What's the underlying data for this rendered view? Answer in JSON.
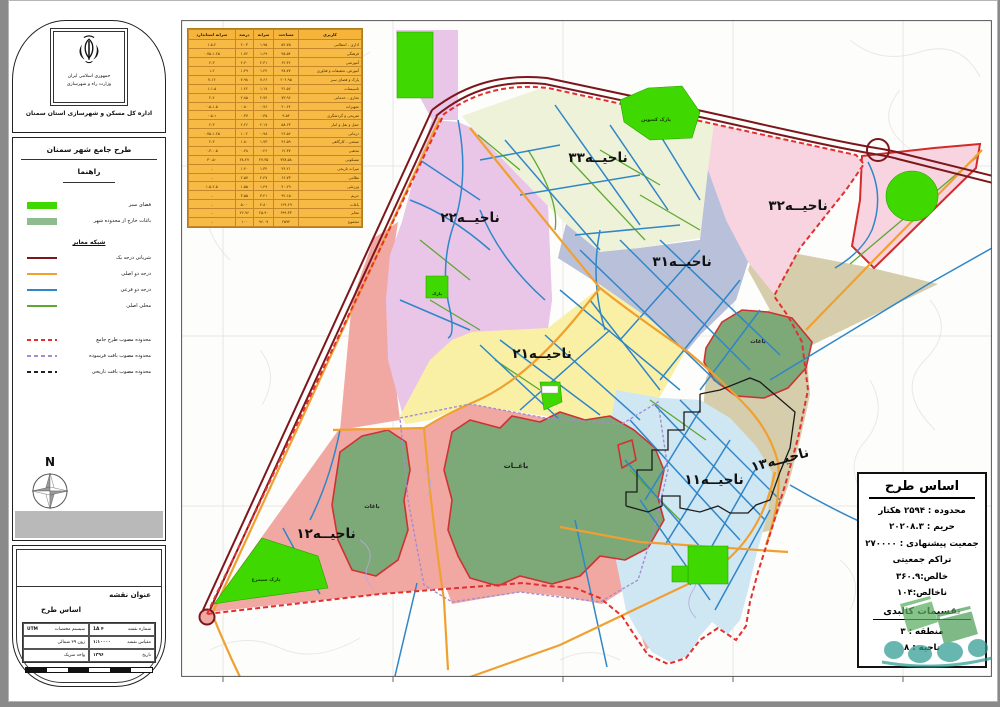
{
  "sidebar": {
    "agency": {
      "line1": "جمهوری اسلامی ایران",
      "line2": "وزارت راه و شهرسازی",
      "line3": "اداره کل مسکن و شهرسازی استان سمنان"
    },
    "legend": {
      "title": "طرح جامع شهر سمنان",
      "subtitle": "راهنما",
      "area_items": [
        {
          "label": "فضای سبز",
          "color": "#3fd800"
        },
        {
          "label": "باغات خارج از محدوده شهر",
          "color": "#8fbc8f"
        }
      ],
      "roads_header": "شبکه معابر",
      "road_items": [
        {
          "label": "شریانی درجه یک",
          "color": "#7b171c"
        },
        {
          "label": "درجه دو اصلی",
          "color": "#f0a030"
        },
        {
          "label": "درجه دو فرعی",
          "color": "#2f86c8"
        },
        {
          "label": "محلی اصلی",
          "color": "#5ea832"
        }
      ],
      "boundary_items": [
        {
          "label": "محدوده مصوب طرح جامع",
          "color": "#e23030"
        },
        {
          "label": "محدوده مصوب بافت فرسوده",
          "color": "#a58cd0"
        },
        {
          "label": "محدوده مصوب بافت تاریخی",
          "color": "#222222"
        }
      ],
      "north_label": "N"
    },
    "titleblock": {
      "heading": "عنوان نقشه",
      "map_title": "اساس طرح",
      "cells": {
        "sheet_no_label": "شماره نقشه",
        "sheet_no": "۴ 1A",
        "scale_label": "مقیاس نقشه",
        "scale": "۱:۱۰۰۰۰",
        "date_label": "تاریخ",
        "date": "۱۳۹۶",
        "coord_label": "سیستم مختصات",
        "coord": "UTM",
        "zone": "زون ۳۹ شمالی",
        "unit": "واحد متریک"
      }
    }
  },
  "landuse_table": {
    "headers": [
      "کاربری",
      "مساحت",
      "سرانه",
      "درصد",
      "سرانه استاندارد"
    ],
    "rows": [
      [
        "اداری - انتظامی",
        "۵۲.۷۵",
        "۱.۹۵",
        "۲.۰۳",
        "۱.۵-۲"
      ],
      [
        "فرهنگی",
        "۴۵.۵۴",
        "۱.۶۹",
        "۱.۷۶",
        "۰.۷۵-۱.۲۵"
      ],
      [
        "آموزشی",
        "۶۲.۳۶",
        "۲.۳۱",
        "۲.۴۰",
        "۲-۳"
      ],
      [
        "آموزش، تحقیقات و فناوری",
        "۳۸.۷۷",
        "۱.۴۴",
        "۱.۴۹",
        "۱-۲"
      ],
      [
        "پارک و فضای سبز",
        "۲۰۶.۹۵",
        "۷.۶۶",
        "۷.۹۸",
        "۷-۱۲"
      ],
      [
        "تاسیسات",
        "۳۱.۵۶",
        "۱.۱۷",
        "۱.۲۲",
        "۱-۱.۵"
      ],
      [
        "تجاری - خدماتی",
        "۷۳.۹۶",
        "۲.۷۴",
        "۲.۸۵",
        "۲-۴"
      ],
      [
        "تجهیزات",
        "۲۰.۶۴",
        "۰.۷۶",
        "۰.۸۰",
        "۰.۵-۱.۵"
      ],
      [
        "تفریحی و گردشگری",
        "۹.۵۴",
        "۰.۳۵",
        "۰.۳۷",
        "۰.۵-۱"
      ],
      [
        "حمل و نقل و انبار",
        "۵۸.۶۳",
        "۲.۱۷",
        "۲.۲۶",
        "۲-۳"
      ],
      [
        "درمانی",
        "۲۶.۵۶",
        "۰.۹۸",
        "۱.۰۲",
        "۰.۷۵-۱.۲۵"
      ],
      [
        "صنعتی - کارگاهی",
        "۴۶.۵۹",
        "۱.۷۳",
        "۱.۸۰",
        "۲-۳"
      ],
      [
        "مذهبی",
        "۱۲.۳۷",
        "۰.۴۶",
        "۰.۴۸",
        "۰.۳-۰.۵"
      ],
      [
        "مسکونی",
        "۷۳۸.۵۸",
        "۲۷.۳۵",
        "۲۸.۴۷",
        "۳۰-۵۰"
      ],
      [
        "میراث تاریخی",
        "۳۶.۲۱",
        "۱.۳۴",
        "۱.۴۰",
        "-"
      ],
      [
        "نظامی",
        "۶۶.۷۳",
        "۲.۴۷",
        "۲.۵۷",
        "-"
      ],
      [
        "ورزشی",
        "۴۰.۲۹",
        "۱.۴۹",
        "۱.۵۵",
        "۱.۵-۲.۵"
      ],
      [
        "حریم",
        "۹۲.۱۵",
        "۳.۴۱",
        "۳.۵۵",
        "-"
      ],
      [
        "باغات",
        "۱۲۹.۶۹",
        "۴.۸۰",
        "۵.۰۰",
        "-"
      ],
      [
        "معابر",
        "۶۹۹.۳۳",
        "۲۵.۹۰",
        "۲۶.۹۶",
        "-"
      ],
      [
        "مجموع",
        "۲۵۹۴",
        "۹۶.۰۷",
        "۱۰۰",
        "-"
      ]
    ]
  },
  "map": {
    "districts": [
      {
        "id": "33",
        "label": "ناحیــه۳۳"
      },
      {
        "id": "32",
        "label": "ناحیــه۳۲"
      },
      {
        "id": "31",
        "label": "ناحیــه۳۱"
      },
      {
        "id": "22",
        "label": "ناحیــه۲۲"
      },
      {
        "id": "21",
        "label": "ناحیــه۲۱"
      },
      {
        "id": "13",
        "label": "ناحیــه۱۳"
      },
      {
        "id": "11",
        "label": "ناحیــه۱۱"
      },
      {
        "id": "12",
        "label": "ناحیــه۱۲"
      }
    ],
    "labels": {
      "gardens_big": "باغــات",
      "gardens": "باغات",
      "park_kosvin": "پارک کسوین",
      "park_simorgh": "پارک سیمرغ",
      "park_small": "پارک"
    },
    "info_box": {
      "title": "اساس طرح",
      "lines": [
        "محدوده : ۲۵۹۴ هکتار",
        "حریم : ۲۰۲۰۸.۳",
        "جمعیت پیشنهادی : ۲۷۰۰۰۰",
        "تراکم جمعیتی",
        "خالص:۳۶۰.۹",
        "ناخالص:۱۰۴"
      ],
      "divisions_header": "تقسیمات کالبدی",
      "division_lines": [
        "منطقه : ۳",
        "ناحیه : ۸"
      ]
    },
    "colors": {
      "district33": "#eef2d8",
      "district32": "#f7d4e0",
      "district31": "#b9c0da",
      "district22": "#e9c5e8",
      "district21": "#f9f0a6",
      "district13": "#d5cdab",
      "district11": "#cfe6f3",
      "district12_worn": "#f2a8a2",
      "gardens": "#7da877",
      "park_green": "#3fd800",
      "highway": "#7b171c",
      "road_primary": "#f0a030",
      "road_secondary": "#2f86c8",
      "road_local": "#5ea832",
      "boundary_plan": "#e23030"
    }
  }
}
